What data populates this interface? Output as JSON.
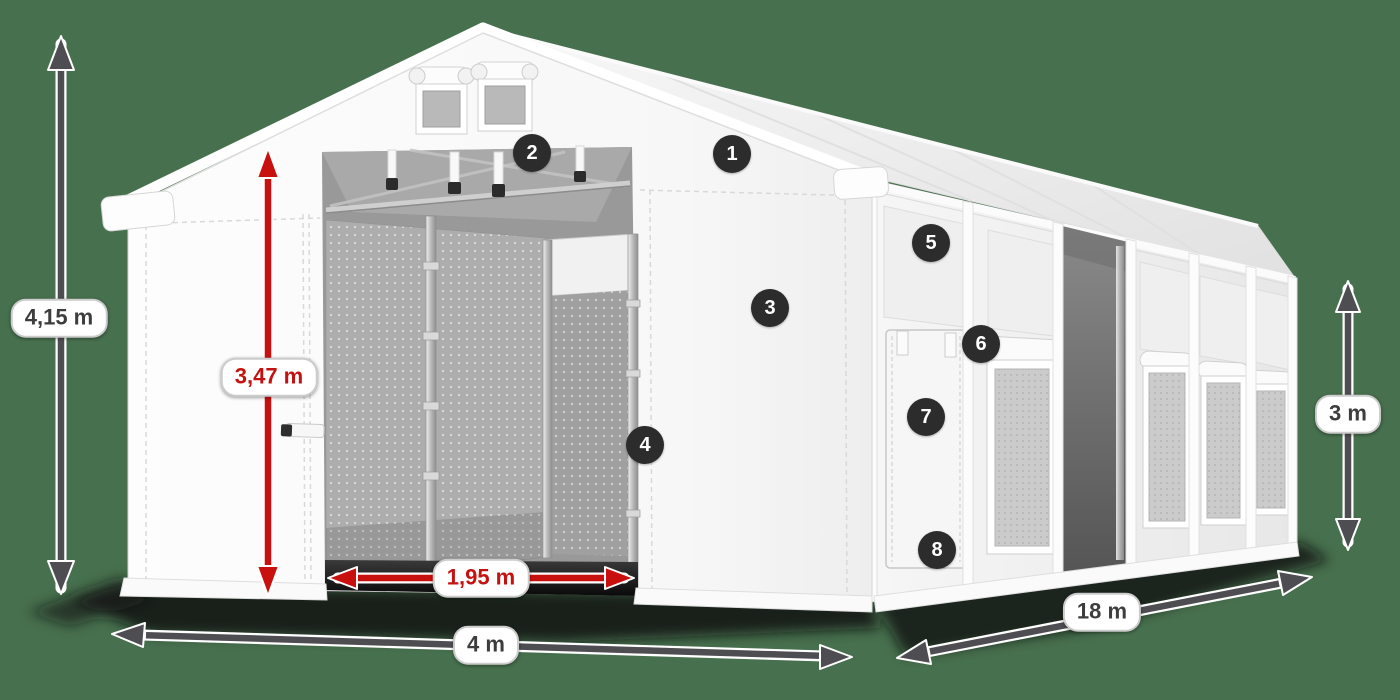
{
  "dimensions": {
    "total_height": {
      "label": "4,15 m",
      "style": "gray"
    },
    "entrance_height": {
      "label": "3,47 m",
      "style": "red"
    },
    "entrance_width": {
      "label": "1,95 m",
      "style": "red"
    },
    "width": {
      "label": "4 m",
      "style": "gray"
    },
    "length": {
      "label": "18 m",
      "style": "gray"
    },
    "side_height": {
      "label": "3 m",
      "style": "gray"
    }
  },
  "markers": [
    {
      "number": "1"
    },
    {
      "number": "2"
    },
    {
      "number": "3"
    },
    {
      "number": "4"
    },
    {
      "number": "5"
    },
    {
      "number": "6"
    },
    {
      "number": "7"
    },
    {
      "number": "8"
    }
  ],
  "colors": {
    "background": "#47704e",
    "arrow_gray": "#4e4e52",
    "arrow_red": "#c8100f",
    "label_text_gray": "#3d3d3d",
    "label_text_red": "#c41210",
    "pill_background": "#ffffff",
    "pill_border": "#cccccc",
    "badge_background": "#2c2c2c",
    "badge_text": "#ffffff",
    "tent_white": "#ffffff"
  }
}
